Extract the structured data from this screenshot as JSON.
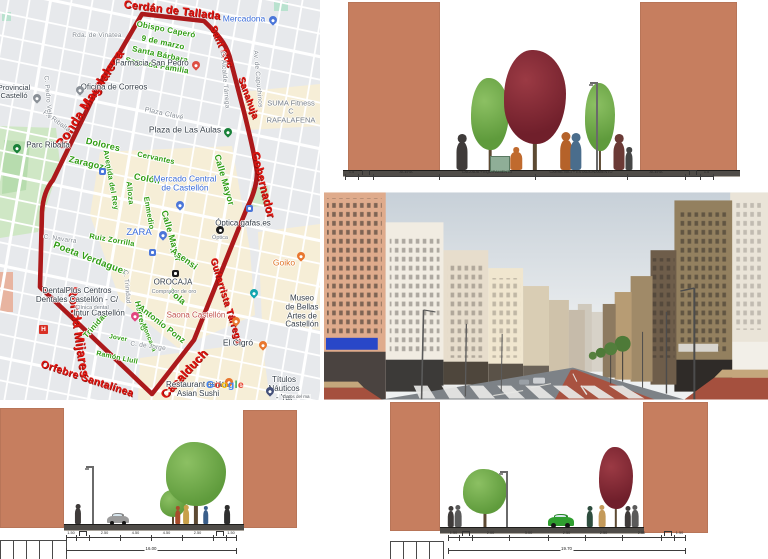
{
  "colors": {
    "terracotta": "#c67e5f",
    "route_red": "#ac191b",
    "street_label_red": "#e0140f",
    "street_label_green": "#2f9c12",
    "map_background": "#e7e9ec",
    "map_zone_cream": "#f6eed7",
    "map_park_green": "#cfe7c5",
    "poi_blue": "#3b6cd8",
    "bike_lane_red": "#a85240",
    "green_car": "#2f9e2f"
  },
  "map": {
    "red_labels": [
      [
        "Cerdán de Tallada",
        172,
        11,
        7,
        11
      ],
      [
        "Sant Roc",
        221,
        47,
        66,
        10
      ],
      [
        "Ronda Magdalena",
        89,
        99,
        -57,
        13
      ],
      [
        "Sanahuja",
        248,
        98,
        70,
        9.5
      ],
      [
        "Gobernador",
        262,
        185,
        76,
        11.5
      ],
      [
        "Ronda Mijares",
        79,
        332,
        82,
        13
      ],
      [
        "Guitarrista Tárrega",
        226,
        301,
        73,
        9.5
      ],
      [
        "Casalduch",
        184,
        374,
        -47,
        12
      ],
      [
        "Orfebre Santalínea",
        87,
        379,
        18,
        10.5
      ]
    ],
    "green_labels": [
      [
        "Obispo Caperó",
        166,
        30,
        11,
        8
      ],
      [
        "9 de marzo",
        163,
        43,
        12,
        8
      ],
      [
        "Santa Bárbara",
        160,
        55,
        12,
        8
      ],
      [
        "Sagrada Familia",
        157,
        66,
        10,
        8
      ],
      [
        "Dolores",
        103,
        145,
        13,
        9
      ],
      [
        "Zaragoza",
        89,
        164,
        13,
        9
      ],
      [
        "Cervantes",
        156,
        158,
        12,
        7.5
      ],
      [
        "Colón",
        147,
        179,
        10,
        9
      ],
      [
        "Avenida del Rey",
        111,
        180,
        80,
        7.5
      ],
      [
        "Alloza",
        130,
        193,
        84,
        7.5
      ],
      [
        "Enmedio",
        149,
        213,
        80,
        7.5
      ],
      [
        "Calle Mayor",
        224,
        180,
        74,
        9
      ],
      [
        "Calle Mayor",
        171,
        236,
        74,
        9
      ],
      [
        "Ruiz Zorrilla",
        112,
        240,
        10,
        7.5
      ],
      [
        "Asensi",
        184,
        259,
        36,
        9
      ],
      [
        "Poeta Verdaguer",
        90,
        259,
        21,
        9.5
      ],
      [
        "Herrero",
        140,
        316,
        78,
        8
      ],
      [
        "Fola",
        177,
        297,
        40,
        9
      ],
      [
        "Antonio Ponz",
        162,
        324,
        38,
        8.5
      ],
      [
        "Trinidad",
        96,
        325,
        -48,
        8
      ],
      [
        "Jover",
        118,
        339,
        10,
        6.5
      ],
      [
        "Ramón Llull",
        117,
        358,
        12,
        7
      ],
      [
        "Moncada",
        148,
        338,
        68,
        6.5
      ]
    ],
    "gray_labels": [
      [
        "Rda. de Vinatea",
        97,
        36,
        0,
        6.5
      ],
      [
        "P.º Ribalta",
        56,
        122,
        36,
        6.5
      ],
      [
        "C. Pedro Vela",
        47,
        97,
        85,
        6.5
      ],
      [
        "C. Navarra",
        60,
        240,
        8,
        6.5
      ],
      [
        "C. Trinidad",
        126,
        287,
        85,
        6.5
      ],
      [
        "C. de Jorge",
        148,
        347,
        8,
        6.5
      ],
      [
        "C. Alcalde Tárrega",
        224,
        80,
        85,
        6.5
      ],
      [
        "Av. de Capuchinos",
        257,
        79,
        85,
        6.5
      ],
      [
        "Plaza Clavé",
        164,
        114,
        12,
        7
      ]
    ],
    "pois": [
      [
        "Mercadona",
        244,
        19,
        "blue",
        8.5
      ],
      [
        "Farmacia San Pedro",
        152,
        64,
        "dark",
        8
      ],
      [
        "Oficina de Correos",
        114,
        88,
        "dark",
        8
      ],
      [
        "Provincial\nCastelló",
        14,
        92,
        "dark",
        7.5
      ],
      [
        "Parc Ribalta",
        48,
        146,
        "dark",
        8
      ],
      [
        "SUMA Fitness C\nRAFALAFENA",
        291,
        112,
        "gray",
        7.5
      ],
      [
        "Plaza de Las Aulas",
        185,
        130,
        "dark",
        8.5
      ],
      [
        "Mercado Central\nde Castellón",
        185,
        184,
        "blue",
        8.5
      ],
      [
        "ZARA",
        139,
        233,
        "blue",
        9.5
      ],
      [
        "Óptica gafas.es",
        243,
        224,
        "dark",
        8
      ],
      [
        "Óptica",
        220,
        238,
        "gray",
        5.5
      ],
      [
        "OROCAJA",
        173,
        283,
        "dark",
        8
      ],
      [
        "Comprador de oro",
        174,
        292,
        "gray",
        5.5
      ],
      [
        "Goiko",
        284,
        263,
        "orange",
        8.5
      ],
      [
        "Museo de Bellas\nArtes de Castellón",
        302,
        312,
        "dark",
        8
      ],
      [
        "Saona Castellón",
        196,
        316,
        "salmon",
        8
      ],
      [
        "Intur Castellón",
        99,
        314,
        "dark",
        8
      ],
      [
        "El Cigró",
        238,
        343,
        "dark",
        8.5
      ],
      [
        "Restaurant asiátic\nAsian Sushi",
        198,
        390,
        "dark",
        8
      ],
      [
        "Títulos Náuticos\n- Yat",
        284,
        389,
        "dark",
        8
      ],
      [
        "DentalPlus Centros\nDentales Castellón - C/",
        77,
        296,
        "dark",
        8
      ],
      [
        "Clínica dental",
        92,
        308,
        "gray",
        5.5
      ]
    ],
    "pins": [
      [
        "drop",
        "#4b76d9",
        269,
        16
      ],
      [
        "drop",
        "#dd4f43",
        192,
        61
      ],
      [
        "drop",
        "#8a9097",
        76,
        86
      ],
      [
        "drop",
        "#8a9097",
        33,
        94
      ],
      [
        "drop",
        "#188038",
        13,
        144
      ],
      [
        "drop",
        "#188038",
        224,
        128
      ],
      [
        "drop",
        "#4b76d9",
        176,
        201
      ],
      [
        "drop",
        "#4b76d9",
        159,
        231
      ],
      [
        "drop",
        "#e8762e",
        297,
        252
      ],
      [
        "drop",
        "#12a5af",
        250,
        289
      ],
      [
        "drop",
        "#e8762e",
        232,
        317
      ],
      [
        "drop",
        "#e2447f",
        131,
        312
      ],
      [
        "drop",
        "#e8762e",
        259,
        341
      ],
      [
        "drop",
        "#e8762e",
        225,
        378
      ],
      [
        "drop",
        "#44507a",
        266,
        387
      ],
      [
        "hsq",
        "#d93025",
        39,
        325
      ],
      [
        "sq",
        "#4b76d9",
        99,
        168
      ],
      [
        "sq",
        "#4b76d9",
        149,
        249
      ],
      [
        "sq",
        "#4b76d9",
        246,
        205
      ],
      [
        "dot",
        "#1c1c1c",
        216,
        226
      ],
      [
        "sq",
        "#1c1c1c",
        172,
        270
      ]
    ],
    "google": {
      "text": "Google",
      "letter_colors": [
        "#4285F4",
        "#EA4335",
        "#FBBC05",
        "#4285F4",
        "#34A853",
        "#EA4335"
      ]
    },
    "attribution": "Datos del ma"
  },
  "sections": [
    {
      "name": "section-top",
      "blocks": [
        [
          348,
          2,
          92,
          170
        ],
        [
          640,
          2,
          97,
          170
        ]
      ],
      "ground": [
        343,
        170,
        397,
        5
      ],
      "trees": [
        [
          490,
          170,
          92,
          38,
          "green"
        ],
        [
          535,
          170,
          120,
          62,
          "red"
        ],
        [
          600,
          170,
          87,
          30,
          "green"
        ]
      ],
      "lamps": [
        [
          596,
          170,
          88
        ]
      ],
      "planters": [
        [
          490,
          156,
          18,
          14
        ]
      ],
      "people": [
        [
          462,
          170,
          36,
          "#3f3b3a",
          0
        ],
        [
          516,
          170,
          23,
          "#c06a2e",
          1
        ],
        [
          566,
          170,
          38,
          "#b5622a",
          0
        ],
        [
          576,
          170,
          37,
          "#4a6d8c",
          0
        ],
        [
          619,
          170,
          36,
          "#6b3a36",
          0
        ],
        [
          629,
          170,
          23,
          "#454545",
          0
        ]
      ],
      "cars": [],
      "cells": null,
      "dims": {
        "x0": 345,
        "y": 176,
        "segs": [
          [
            13,
            "1.5"
          ],
          [
            15,
            "b"
          ],
          [
            66,
            "ACERA"
          ],
          [
            96,
            "CALZADA + EQUIPAMIENTO"
          ],
          [
            92,
            "CARRIL BICI + ESTACIONAMIENTO"
          ],
          [
            58,
            "ACERA"
          ],
          [
            15,
            "b"
          ],
          [
            13,
            "1.5"
          ]
        ],
        "total": null
      }
    },
    {
      "name": "section-bottom-left",
      "blocks": [
        [
          0,
          408,
          64,
          120
        ],
        [
          243,
          410,
          54,
          118
        ]
      ],
      "ground": [
        64,
        524,
        180,
        5
      ],
      "trees": [
        [
          173,
          524,
          34,
          26,
          "green"
        ],
        [
          196,
          524,
          82,
          60,
          "green"
        ]
      ],
      "lamps": [
        [
          92,
          524,
          58
        ]
      ],
      "planters": [],
      "people": [
        [
          78,
          524,
          20,
          "#3f3b3a",
          0
        ],
        [
          178,
          524,
          18,
          "#a84c2c",
          0
        ],
        [
          186,
          524,
          19,
          "#c8a04a",
          0
        ],
        [
          206,
          524,
          18,
          "#3a5e8a",
          0
        ],
        [
          227,
          524,
          19,
          "#2f2f2f",
          0
        ]
      ],
      "cars": [
        [
          107,
          524,
          22,
          "#9b9b9b"
        ]
      ],
      "cells": [
        0,
        540,
        5,
        13,
        19
      ],
      "dims": {
        "x0": 66,
        "y": 537,
        "segs": [
          [
            10,
            "1.50"
          ],
          [
            13,
            "b"
          ],
          [
            31,
            "2.50"
          ],
          [
            31,
            "4.50"
          ],
          [
            31,
            "4.50"
          ],
          [
            31,
            "2.50"
          ],
          [
            13,
            "b"
          ],
          [
            10,
            "1.50"
          ]
        ],
        "total": [
          "16.00",
          550
        ]
      }
    },
    {
      "name": "section-bottom-right",
      "blocks": [
        [
          390,
          402,
          50,
          129
        ],
        [
          643,
          402,
          65,
          131
        ]
      ],
      "ground": [
        440,
        527,
        204,
        5
      ],
      "trees": [
        [
          485,
          527,
          58,
          44,
          "green"
        ],
        [
          616,
          527,
          80,
          34,
          "red"
        ]
      ],
      "lamps": [
        [
          506,
          527,
          56
        ]
      ],
      "planters": [],
      "people": [
        [
          451,
          527,
          21,
          "#3f3b3a",
          0
        ],
        [
          458,
          527,
          22,
          "#5a5a5a",
          0
        ],
        [
          590,
          527,
          21,
          "#2e4d3e",
          0
        ],
        [
          602,
          527,
          22,
          "#c49a5a",
          0
        ],
        [
          628,
          527,
          21,
          "#3f3b3a",
          0
        ],
        [
          635,
          527,
          22,
          "#5a5a5a",
          0
        ]
      ],
      "cars": [
        [
          548,
          527,
          26,
          "#2f9e2f"
        ]
      ],
      "cells": [
        390,
        541,
        4,
        13,
        18
      ],
      "dims": {
        "x0": 448,
        "y": 537,
        "segs": [
          [
            11,
            "1.50"
          ],
          [
            13,
            "b"
          ],
          [
            37,
            "2.00"
          ],
          [
            39,
            "3.00"
          ],
          [
            37,
            "2.50"
          ],
          [
            37,
            "2.50"
          ],
          [
            39,
            "2.00"
          ],
          [
            13,
            "b"
          ],
          [
            11,
            "1.50"
          ]
        ],
        "total": [
          "19.70",
          550
        ]
      }
    }
  ]
}
